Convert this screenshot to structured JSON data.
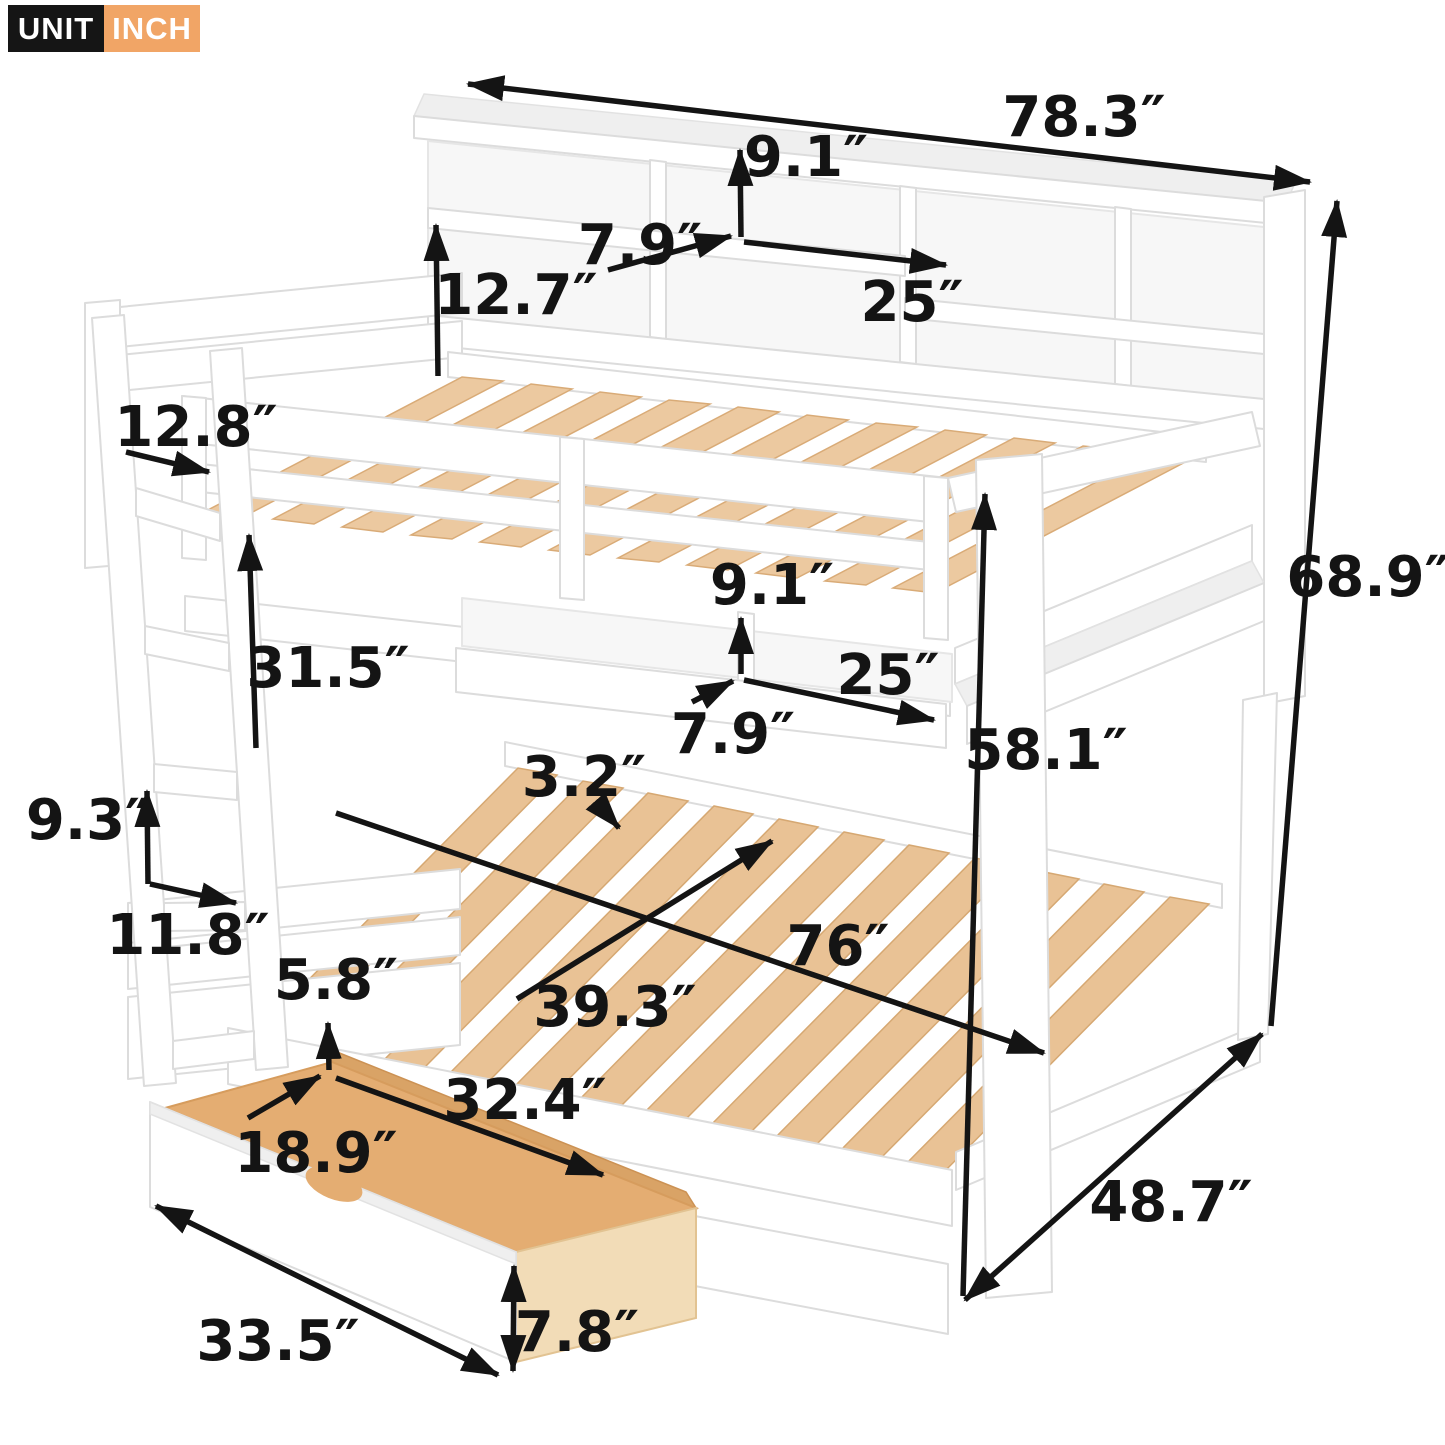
{
  "badge": {
    "unit_label": "UNIT",
    "unit_value": "INCH"
  },
  "colors": {
    "badge_unit_bg": "#151515",
    "badge_inch_bg": "#f1a566",
    "dimension_color": "#141414",
    "frame_white": "#ffffff",
    "slat_wood": "#ecc9a0",
    "drawer_plywood": "#e4ad72"
  },
  "dimensions": [
    {
      "id": "overall-length",
      "value": "78.3″"
    },
    {
      "id": "top-shelf-height",
      "value": "9.1″"
    },
    {
      "id": "top-shelf-depth",
      "value": "7.9″"
    },
    {
      "id": "top-shelf-width",
      "value": "25″"
    },
    {
      "id": "bookcase-height",
      "value": "12.7″"
    },
    {
      "id": "headboard-depth",
      "value": "12.8″"
    },
    {
      "id": "bunk-clearance",
      "value": "31.5″"
    },
    {
      "id": "mid-shelf-height",
      "value": "9.1″"
    },
    {
      "id": "mid-shelf-width",
      "value": "25″"
    },
    {
      "id": "mid-shelf-depth",
      "value": "7.9″"
    },
    {
      "id": "rail-height",
      "value": "58.1″"
    },
    {
      "id": "overall-height",
      "value": "68.9″"
    },
    {
      "id": "slat-gap",
      "value": "3.2″"
    },
    {
      "id": "bed-length",
      "value": "76″"
    },
    {
      "id": "bed-width",
      "value": "39.3″"
    },
    {
      "id": "ladder-rung-spacing",
      "value": "9.3″"
    },
    {
      "id": "base-clearance",
      "value": "11.8″"
    },
    {
      "id": "drawer-inner-height",
      "value": "5.8″"
    },
    {
      "id": "drawer-inner-width",
      "value": "18.9″"
    },
    {
      "id": "drawer-inner-length",
      "value": "32.4″"
    },
    {
      "id": "drawer-length",
      "value": "33.5″"
    },
    {
      "id": "drawer-front-height",
      "value": "7.8″"
    },
    {
      "id": "overall-depth",
      "value": "48.7″"
    }
  ]
}
